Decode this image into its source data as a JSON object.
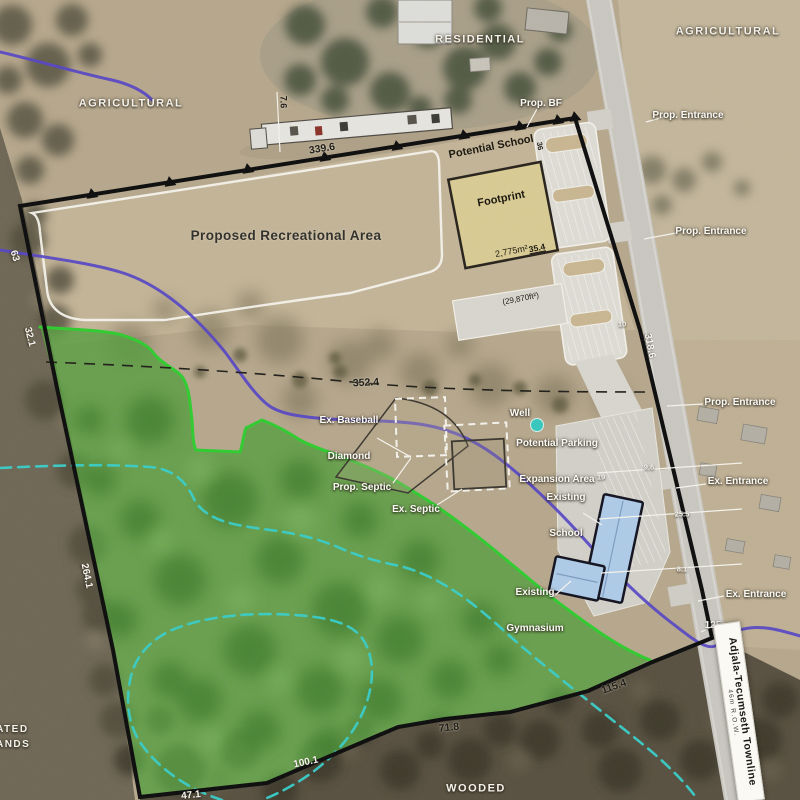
{
  "site": {
    "zones": {
      "residential": "RESIDENTIAL",
      "agricultural_east": "AGRICULTURAL",
      "agricultural_west": "AGRICULTURAL",
      "wooded": "WOODED",
      "wetlands_line1": "EVALUATED",
      "wetlands_line2": "WETLANDS"
    },
    "features": {
      "prop_bf": "Prop. BF",
      "prop_entrance": "Prop. Entrance",
      "ex_entrance": "Ex. Entrance",
      "well": "Well",
      "parking_expansion_line1": "Potential Parking",
      "parking_expansion_line2": "Expansion Area",
      "existing_school_line1": "Existing",
      "existing_school_line2": "School",
      "existing_gym_line1": "Existing",
      "existing_gym_line2": "Gymnasium",
      "baseball_line1": "Ex. Baseball",
      "baseball_line2": "Diamond",
      "prop_septic": "Prop. Septic",
      "ex_septic": "Ex. Septic",
      "rec_area": "Proposed Recreational Area"
    },
    "school_footprint": {
      "name_line1": "Potential School",
      "name_line2": "Footprint",
      "area_metric": "2,775m²",
      "area_imperial": "(29,870ft²)",
      "frontage": "35.4"
    },
    "road": {
      "name": "Adjala-Tecumseth Townline",
      "row": "46m R.O.W."
    },
    "measurements": {
      "north": "339.6",
      "north_setback": "7.6",
      "mid_dashed": "352.4",
      "road_frontage": "318.6",
      "west_upper": "63",
      "west_mid": "32.1",
      "west_lower": "264.1",
      "south_east": "115.4",
      "south_mid": "71.8",
      "south_west": "100.1",
      "south_corner": "47.1",
      "road_south": "125",
      "parking_north": "36",
      "road_gap": "10",
      "parking_dim": "19",
      "gap_a": "9.6",
      "gap_b": "25.5",
      "gap_c": "8.1"
    },
    "colors": {
      "site_boundary": "#0b0b0b",
      "natural_area_overlay": "#579d3f",
      "natural_area_edge": "#2ecc2e",
      "watercourse": "#5544c4",
      "wetland_boundary": "#38cdc8",
      "school_footprint_fill": "#d9cb93",
      "existing_building_fill": "#aecbe8",
      "well_marker": "#35c8be"
    }
  }
}
